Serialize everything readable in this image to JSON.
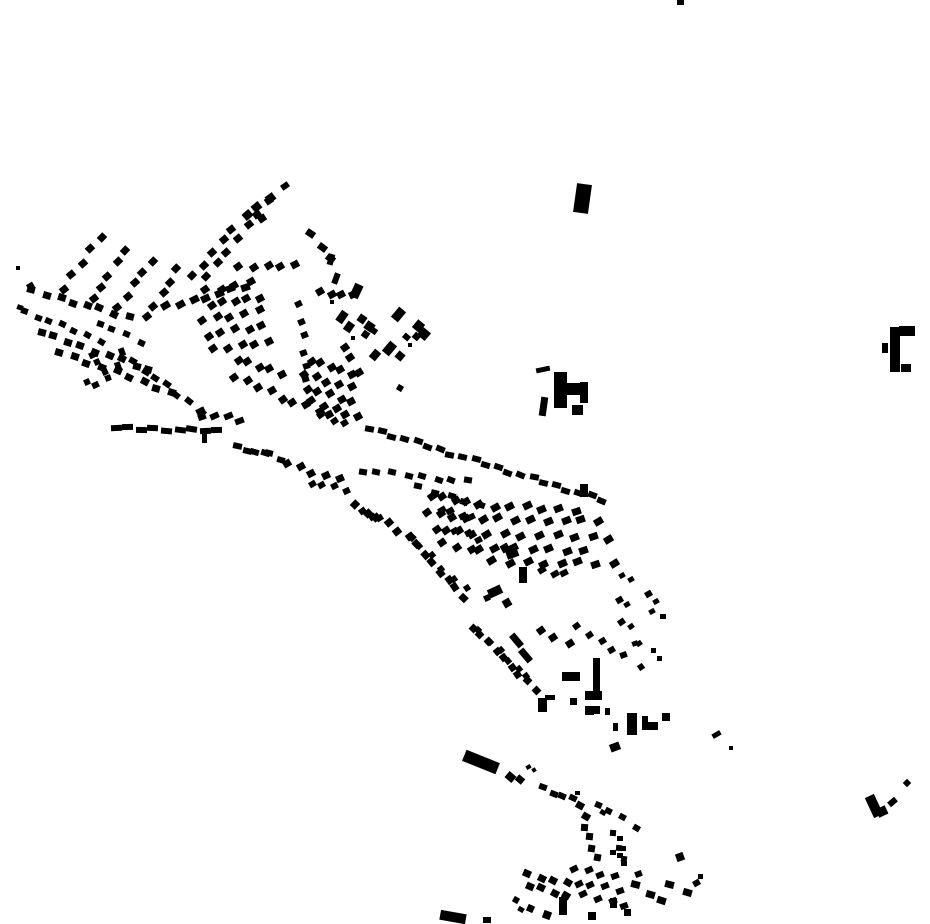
{
  "map": {
    "kind": "building-footprint-map",
    "width": 930,
    "height": 924,
    "background_color": "#ffffff",
    "building_color": "#000000",
    "strips": [
      [
        33,
        291,
        128,
        317,
        8,
        8,
        7,
        20
      ],
      [
        24,
        312,
        100,
        340,
        7,
        7,
        6,
        25
      ],
      [
        40,
        332,
        150,
        370,
        9,
        8,
        7,
        20
      ],
      [
        60,
        352,
        172,
        392,
        9,
        8,
        7,
        22
      ],
      [
        100,
        322,
        140,
        342,
        4,
        7,
        6,
        25
      ],
      [
        167,
        307,
        245,
        287,
        7,
        9,
        7,
        -25
      ],
      [
        192,
        276,
        233,
        229,
        5,
        8,
        7,
        -40
      ],
      [
        100,
        237,
        64,
        288,
        5,
        8,
        7,
        -40
      ],
      [
        126,
        250,
        92,
        300,
        5,
        8,
        7,
        -40
      ],
      [
        152,
        260,
        118,
        308,
        5,
        8,
        7,
        -40
      ],
      [
        178,
        270,
        146,
        316,
        5,
        8,
        7,
        -40
      ],
      [
        133,
        362,
        200,
        410,
        7,
        8,
        6,
        35
      ],
      [
        115,
        428,
        218,
        431,
        9,
        11,
        6,
        3
      ],
      [
        207,
        276,
        268,
        201,
        7,
        8,
        7,
        -40
      ],
      [
        247,
        213,
        270,
        200,
        3,
        9,
        8,
        -35
      ],
      [
        240,
        268,
        294,
        264,
        5,
        8,
        7,
        -30
      ],
      [
        205,
        290,
        250,
        283,
        4,
        8,
        7,
        -30
      ],
      [
        210,
        305,
        260,
        297,
        5,
        8,
        7,
        -30
      ],
      [
        203,
        320,
        258,
        311,
        5,
        8,
        7,
        -30
      ],
      [
        208,
        335,
        262,
        326,
        5,
        8,
        7,
        -30
      ],
      [
        215,
        350,
        268,
        341,
        5,
        8,
        7,
        -30
      ],
      [
        310,
        234,
        331,
        258,
        3,
        9,
        7,
        40
      ],
      [
        237,
        360,
        282,
        373,
        5,
        8,
        7,
        -30
      ],
      [
        235,
        377,
        272,
        390,
        4,
        8,
        7,
        -30
      ],
      [
        282,
        398,
        330,
        415,
        5,
        8,
        7,
        -30
      ],
      [
        202,
        413,
        240,
        419,
        4,
        9,
        6,
        -20
      ],
      [
        237,
        447,
        265,
        455,
        4,
        9,
        6,
        18
      ],
      [
        267,
        453,
        282,
        462,
        2,
        8,
        6,
        20
      ],
      [
        288,
        463,
        338,
        480,
        5,
        8,
        7,
        -25
      ],
      [
        312,
        482,
        345,
        490,
        4,
        7,
        6,
        -25
      ],
      [
        300,
        306,
        307,
        381,
        6,
        7,
        6,
        -20
      ],
      [
        320,
        292,
        352,
        296,
        4,
        8,
        7,
        -25
      ],
      [
        310,
        361,
        352,
        373,
        5,
        8,
        7,
        -30
      ],
      [
        305,
        374,
        350,
        388,
        5,
        8,
        7,
        -30
      ],
      [
        307,
        388,
        352,
        402,
        5,
        8,
        7,
        -30
      ],
      [
        313,
        402,
        357,
        416,
        5,
        8,
        7,
        -30
      ],
      [
        320,
        416,
        345,
        423,
        3,
        7,
        6,
        -30
      ],
      [
        343,
        347,
        358,
        372,
        3,
        8,
        7,
        -30
      ],
      [
        370,
        428,
        602,
        500,
        21,
        9,
        6,
        17
      ],
      [
        362,
        470,
        468,
        482,
        8,
        8,
        6,
        15
      ],
      [
        420,
        488,
        480,
        505,
        5,
        8,
        6,
        18
      ],
      [
        478,
        505,
        575,
        510,
        7,
        9,
        7,
        -25
      ],
      [
        482,
        519,
        598,
        521,
        8,
        9,
        7,
        -25
      ],
      [
        487,
        534,
        610,
        538,
        8,
        9,
        7,
        -25
      ],
      [
        478,
        548,
        585,
        550,
        7,
        9,
        7,
        -25
      ],
      [
        493,
        562,
        613,
        564,
        8,
        9,
        7,
        -25
      ],
      [
        542,
        571,
        565,
        573,
        3,
        8,
        6,
        -25
      ],
      [
        430,
        496,
        468,
        502,
        4,
        8,
        7,
        -30
      ],
      [
        428,
        512,
        466,
        518,
        4,
        8,
        7,
        -30
      ],
      [
        436,
        528,
        470,
        534,
        4,
        8,
        7,
        -30
      ],
      [
        444,
        544,
        470,
        550,
        3,
        8,
        7,
        -30
      ],
      [
        355,
        505,
        410,
        537,
        6,
        8,
        7,
        -40
      ],
      [
        410,
        537,
        463,
        597,
        8,
        7,
        8,
        -40
      ],
      [
        420,
        545,
        465,
        590,
        5,
        6,
        6,
        -35
      ],
      [
        473,
        627,
        535,
        690,
        9,
        7,
        7,
        -40
      ],
      [
        480,
        632,
        528,
        678,
        6,
        6,
        6,
        -40
      ],
      [
        362,
        512,
        380,
        518,
        3,
        7,
        6,
        -30
      ],
      [
        440,
        510,
        473,
        518,
        4,
        8,
        6,
        -25
      ],
      [
        455,
        530,
        480,
        538,
        3,
        7,
        6,
        -25
      ],
      [
        540,
        629,
        570,
        645,
        3,
        8,
        7,
        -30
      ],
      [
        578,
        628,
        612,
        648,
        4,
        7,
        6,
        -30
      ],
      [
        543,
        788,
        572,
        800,
        4,
        8,
        6,
        25
      ],
      [
        578,
        805,
        587,
        818,
        2,
        8,
        7,
        35
      ],
      [
        585,
        827,
        597,
        857,
        4,
        7,
        7,
        10
      ],
      [
        598,
        803,
        635,
        827,
        4,
        7,
        6,
        30
      ],
      [
        615,
        835,
        622,
        860,
        3,
        6,
        6,
        10
      ],
      [
        527,
        874,
        567,
        884,
        4,
        8,
        7,
        30
      ],
      [
        528,
        886,
        568,
        896,
        4,
        8,
        7,
        30
      ],
      [
        575,
        868,
        615,
        876,
        4,
        8,
        6,
        -20
      ],
      [
        578,
        882,
        618,
        890,
        4,
        8,
        6,
        -20
      ],
      [
        585,
        896,
        625,
        904,
        4,
        8,
        6,
        -20
      ],
      [
        635,
        885,
        662,
        900,
        3,
        9,
        7,
        20
      ],
      [
        668,
        884,
        688,
        894,
        2,
        9,
        7,
        20
      ]
    ],
    "rects": [
      [
        680,
        2,
        7,
        5,
        0
      ],
      [
        582,
        198,
        15,
        29,
        8
      ],
      [
        543,
        369,
        14,
        5,
        -12
      ],
      [
        560,
        390,
        13,
        36,
        0
      ],
      [
        575,
        389,
        16,
        12,
        0
      ],
      [
        584,
        392,
        8,
        21,
        0
      ],
      [
        543,
        406,
        7,
        19,
        8
      ],
      [
        577,
        410,
        11,
        10,
        0
      ],
      [
        895,
        349,
        10,
        45,
        0
      ],
      [
        907,
        331,
        16,
        10,
        0
      ],
      [
        885,
        348,
        6,
        10,
        0
      ],
      [
        906,
        368,
        10,
        8,
        0
      ],
      [
        874,
        806,
        10,
        22,
        -25
      ],
      [
        882,
        811,
        10,
        9,
        -25
      ],
      [
        892,
        802,
        9,
        6,
        -40
      ],
      [
        907,
        783,
        6,
        6,
        45
      ],
      [
        716,
        734,
        9,
        5,
        -30
      ],
      [
        731,
        748,
        4,
        4,
        0
      ],
      [
        20,
        307,
        6,
        5,
        20
      ],
      [
        18,
        268,
        4,
        4,
        0
      ],
      [
        30,
        286,
        7,
        6,
        -30
      ],
      [
        285,
        186,
        8,
        6,
        -35
      ],
      [
        262,
        218,
        8,
        7,
        -35
      ],
      [
        92,
        355,
        7,
        6,
        -25
      ],
      [
        97,
        362,
        6,
        6,
        -25
      ],
      [
        105,
        372,
        6,
        6,
        -25
      ],
      [
        108,
        378,
        6,
        6,
        -20
      ],
      [
        95,
        385,
        7,
        6,
        -25
      ],
      [
        87,
        382,
        6,
        6,
        -25
      ],
      [
        122,
        352,
        6,
        8,
        -20
      ],
      [
        118,
        366,
        6,
        8,
        -20
      ],
      [
        204,
        437,
        5,
        11,
        0
      ],
      [
        202,
        417,
        8,
        6,
        -20
      ],
      [
        331,
        259,
        6,
        11,
        15
      ],
      [
        336,
        278,
        6,
        11,
        20
      ],
      [
        356,
        291,
        9,
        14,
        25
      ],
      [
        332,
        302,
        4,
        4,
        0
      ],
      [
        342,
        317,
        8,
        12,
        35
      ],
      [
        349,
        327,
        8,
        10,
        35
      ],
      [
        362,
        319,
        8,
        8,
        35
      ],
      [
        369,
        326,
        9,
        9,
        35
      ],
      [
        365,
        334,
        7,
        7,
        35
      ],
      [
        374,
        331,
        6,
        6,
        35
      ],
      [
        353,
        338,
        4,
        4,
        0
      ],
      [
        398,
        314,
        9,
        13,
        40
      ],
      [
        418,
        326,
        9,
        10,
        40
      ],
      [
        424,
        334,
        10,
        10,
        40
      ],
      [
        416,
        336,
        7,
        7,
        40
      ],
      [
        406,
        337,
        7,
        6,
        40
      ],
      [
        410,
        345,
        4,
        4,
        0
      ],
      [
        389,
        348,
        9,
        13,
        40
      ],
      [
        375,
        355,
        8,
        10,
        40
      ],
      [
        400,
        356,
        8,
        8,
        40
      ],
      [
        400,
        388,
        6,
        6,
        30
      ],
      [
        584,
        490,
        8,
        13,
        0
      ],
      [
        512,
        553,
        12,
        10,
        -20
      ],
      [
        505,
        548,
        8,
        8,
        -30
      ],
      [
        523,
        575,
        8,
        16,
        0
      ],
      [
        495,
        591,
        14,
        9,
        -25
      ],
      [
        487,
        598,
        6,
        6,
        -25
      ],
      [
        507,
        603,
        8,
        8,
        -30
      ],
      [
        516,
        640,
        7,
        15,
        -40
      ],
      [
        525,
        655,
        7,
        15,
        -40
      ],
      [
        623,
        655,
        7,
        6,
        -20
      ],
      [
        635,
        643,
        6,
        5,
        -20
      ],
      [
        571,
        676,
        18,
        9,
        0
      ],
      [
        596,
        677,
        7,
        38,
        0
      ],
      [
        593,
        695,
        17,
        9,
        0
      ],
      [
        542,
        705,
        9,
        14,
        0
      ],
      [
        550,
        697,
        10,
        5,
        0
      ],
      [
        573,
        701,
        7,
        7,
        0
      ],
      [
        589,
        710,
        9,
        9,
        0
      ],
      [
        597,
        710,
        6,
        8,
        0
      ],
      [
        607,
        711,
        5,
        7,
        0
      ],
      [
        632,
        724,
        10,
        22,
        0
      ],
      [
        615,
        747,
        10,
        8,
        -20
      ],
      [
        645,
        723,
        6,
        14,
        0
      ],
      [
        653,
        726,
        10,
        8,
        0
      ],
      [
        666,
        717,
        8,
        8,
        0
      ],
      [
        615,
        727,
        5,
        8,
        0
      ],
      [
        622,
        575,
        6,
        5,
        -30
      ],
      [
        631,
        579,
        6,
        5,
        -30
      ],
      [
        619,
        600,
        7,
        6,
        -30
      ],
      [
        627,
        604,
        6,
        5,
        -30
      ],
      [
        648,
        594,
        7,
        6,
        -30
      ],
      [
        656,
        601,
        6,
        5,
        -30
      ],
      [
        652,
        611,
        6,
        5,
        -30
      ],
      [
        663,
        616,
        6,
        5,
        0
      ],
      [
        621,
        622,
        7,
        6,
        -35
      ],
      [
        631,
        626,
        6,
        5,
        -35
      ],
      [
        639,
        643,
        6,
        5,
        -35
      ],
      [
        641,
        667,
        6,
        6,
        -35
      ],
      [
        653,
        650,
        5,
        5,
        0
      ],
      [
        659,
        658,
        5,
        5,
        0
      ],
      [
        481,
        762,
        36,
        12,
        22
      ],
      [
        510,
        777,
        9,
        8,
        40
      ],
      [
        520,
        779,
        8,
        7,
        40
      ],
      [
        528,
        767,
        5,
        4,
        -30
      ],
      [
        534,
        770,
        4,
        4,
        -30
      ],
      [
        453,
        917,
        26,
        10,
        10
      ],
      [
        487,
        920,
        8,
        6,
        0
      ],
      [
        577,
        793,
        5,
        4,
        0
      ],
      [
        603,
        812,
        6,
        5,
        30
      ],
      [
        620,
        838,
        6,
        5,
        0
      ],
      [
        623,
        848,
        6,
        5,
        0
      ],
      [
        613,
        852,
        6,
        5,
        0
      ],
      [
        620,
        855,
        6,
        5,
        0
      ],
      [
        624,
        863,
        6,
        5,
        0
      ],
      [
        638,
        874,
        7,
        6,
        -20
      ],
      [
        680,
        857,
        8,
        8,
        -20
      ],
      [
        696,
        883,
        7,
        6,
        -30
      ],
      [
        700,
        876,
        5,
        5,
        0
      ],
      [
        563,
        906,
        8,
        18,
        0
      ],
      [
        613,
        903,
        7,
        10,
        0
      ],
      [
        547,
        915,
        8,
        8,
        20
      ],
      [
        592,
        916,
        8,
        8,
        0
      ],
      [
        627,
        912,
        7,
        7,
        0
      ],
      [
        530,
        908,
        7,
        7,
        25
      ],
      [
        516,
        900,
        6,
        6,
        30
      ],
      [
        521,
        909,
        6,
        5,
        30
      ]
    ]
  }
}
